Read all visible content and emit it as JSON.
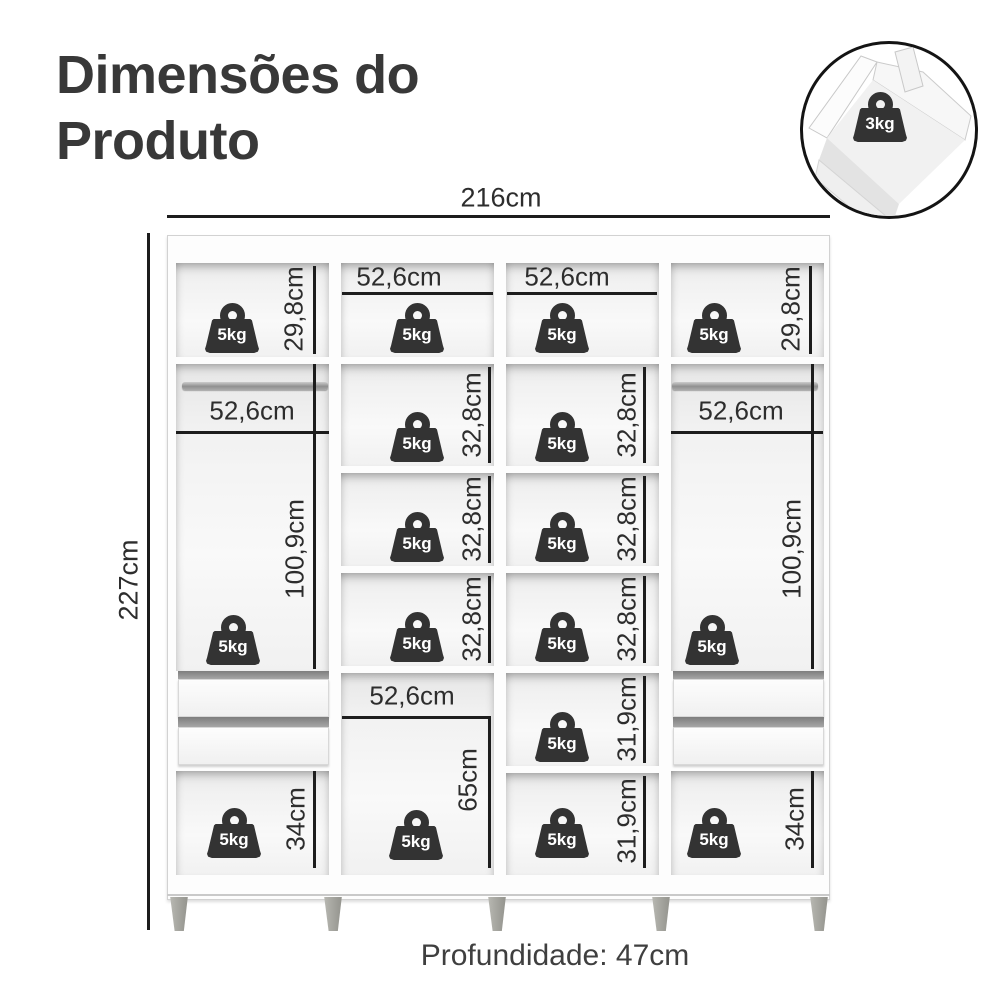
{
  "page": {
    "title_line1": "Dimensões do",
    "title_line2": "Produto",
    "footer_depth": "Profundidade: 47cm"
  },
  "inset": {
    "capacity": "3kg"
  },
  "overall": {
    "width": "216cm",
    "height": "227cm"
  },
  "cells": {
    "row1": [
      {
        "weight": "5kg",
        "height": "29,8cm"
      },
      {
        "weight": "5kg",
        "width": "52,6cm"
      },
      {
        "weight": "5kg",
        "width": "52,6cm"
      },
      {
        "weight": "5kg",
        "height": "29,8cm"
      }
    ],
    "left_column": {
      "hang": {
        "width": "52,6cm",
        "height": "100,9cm",
        "weight": "5kg"
      },
      "drawers_count": 2,
      "bottom": {
        "height": "34cm",
        "weight": "5kg"
      }
    },
    "center_left_column": {
      "shelves": [
        {
          "height": "32,8cm",
          "weight": "5kg"
        },
        {
          "height": "32,8cm",
          "weight": "5kg"
        },
        {
          "height": "32,8cm",
          "weight": "5kg"
        }
      ],
      "lower": {
        "width": "52,6cm",
        "height": "65cm",
        "weight": "5kg"
      }
    },
    "center_right_column": {
      "shelves": [
        {
          "height": "32,8cm",
          "weight": "5kg"
        },
        {
          "height": "32,8cm",
          "weight": "5kg"
        },
        {
          "height": "32,8cm",
          "weight": "5kg"
        },
        {
          "height": "31,9cm",
          "weight": "5kg"
        },
        {
          "height": "31,9cm",
          "weight": "5kg"
        }
      ]
    },
    "right_column": {
      "hang": {
        "width": "52,6cm",
        "height": "100,9cm",
        "weight": "5kg"
      },
      "drawers_count": 2,
      "bottom": {
        "height": "34cm",
        "weight": "5kg"
      }
    }
  },
  "colors": {
    "line": "#1d1d1d",
    "text": "#2d2d2d",
    "icon": "#333333",
    "title": "#383838"
  }
}
